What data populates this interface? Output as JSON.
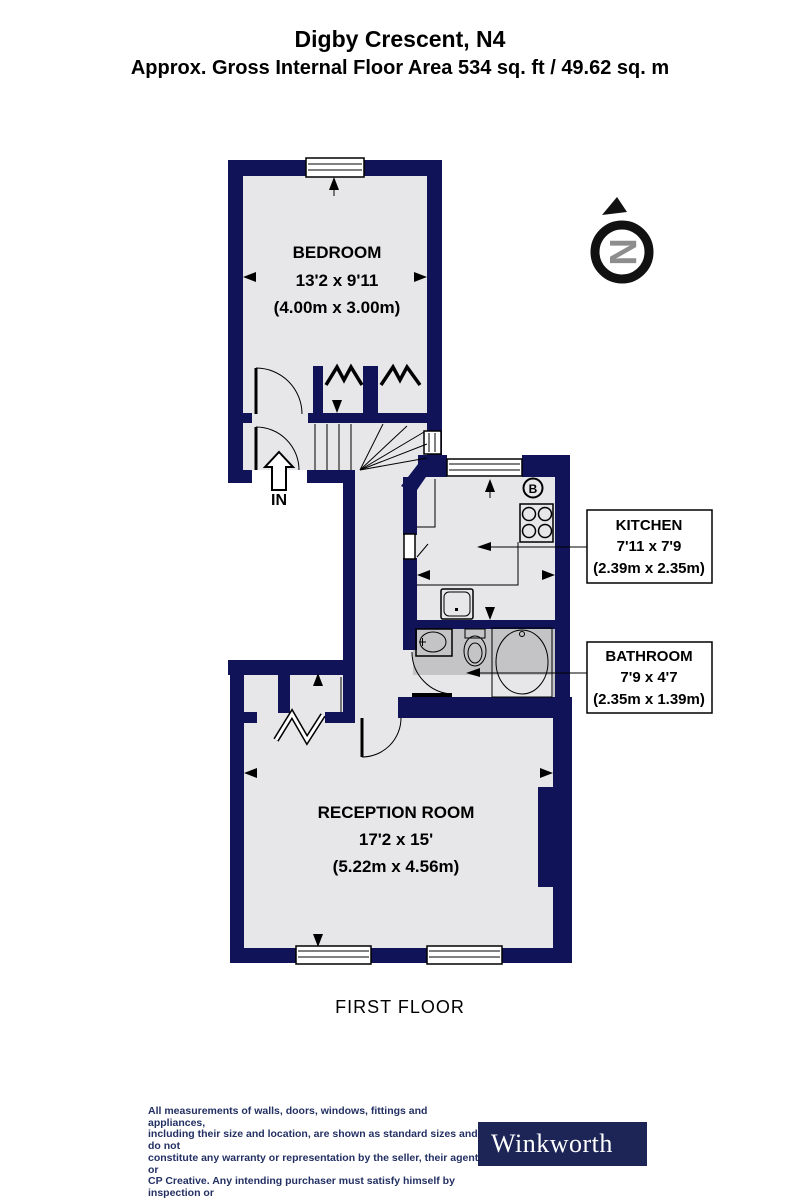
{
  "header": {
    "title": "Digby Crescent, N4",
    "subtitle": "Approx. Gross Internal Floor Area 534 sq. ft / 49.62 sq. m"
  },
  "rooms": {
    "bedroom": {
      "name": "BEDROOM",
      "size_imperial": "13'2 x 9'11",
      "size_metric": "(4.00m x 3.00m)"
    },
    "kitchen": {
      "name": "KITCHEN",
      "size_imperial": "7'11 x 7'9",
      "size_metric": "(2.39m x 2.35m)"
    },
    "bathroom": {
      "name": "BATHROOM",
      "size_imperial": "7'9 x 4'7",
      "size_metric": "(2.35m x 1.39m)"
    },
    "reception": {
      "name": "RECEPTION ROOM",
      "size_imperial": "17'2 x 15'",
      "size_metric": "(5.22m x 4.56m)"
    }
  },
  "plan": {
    "floor_label": "FIRST FLOOR",
    "entrance_label": "IN",
    "boiler_label": "B",
    "compass_letter": "N"
  },
  "footer": {
    "disclaimer_lines": [
      "All measurements of walls, doors, windows, fittings and appliances,",
      "including their size and location, are shown as standard sizes and do not",
      "constitute any warranty or representation by the seller, their agent or",
      "CP Creative. Any intending purchaser must satisfy himself by inspection or",
      "otherwise as to the correctness of the information contained in these plans.",
      "This plan is for illustrative purposes only and should be used as such by",
      "any prospective purchasers."
    ],
    "brand": "Winkworth"
  },
  "colors": {
    "wall_navy": "#101358",
    "floor_light": "#e7e7e9",
    "floor_bath": "#c4c4c6",
    "disclaimer_navy": "#233063",
    "brand_navy": "#1d2557",
    "compass_gray": "#8d8d8d"
  }
}
